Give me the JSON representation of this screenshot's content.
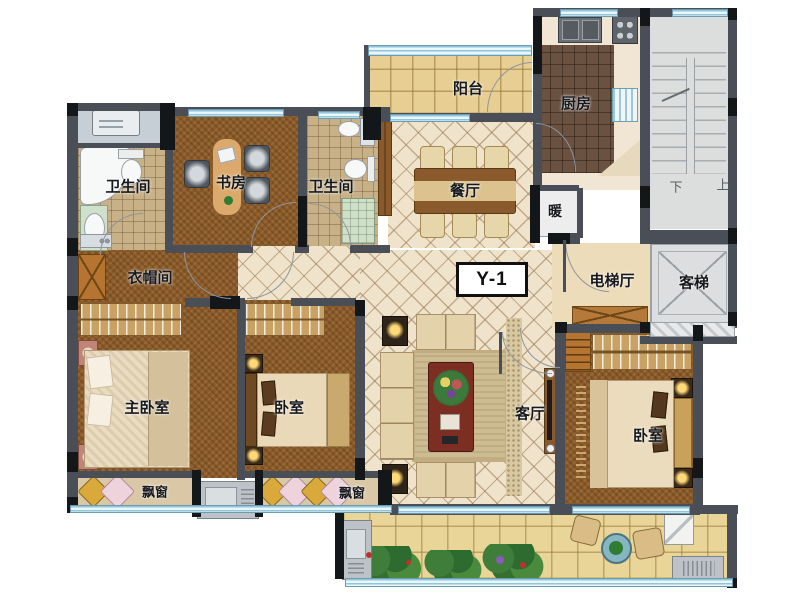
{
  "floorplan": {
    "unit_label": "Y-1",
    "labels": {
      "balcony_top": "阳台",
      "kitchen": "厨房",
      "stairs_down": "下",
      "stairs_up": "上",
      "bath_left": "卫生间",
      "bath_mid": "卫生间",
      "study": "书房",
      "dining": "餐厅",
      "heater": "暖",
      "elevator_hall": "电梯厅",
      "guest_elevator": "客梯",
      "cloakroom": "衣帽间",
      "master_bedroom": "主卧室",
      "bedroom_mid": "卧室",
      "bedroom_right": "卧室",
      "living": "客厅",
      "bay_window_left": "飘窗",
      "bay_window_mid": "飘窗"
    },
    "colors": {
      "wall": "#4a4f57",
      "wall_dark": "#14171a",
      "window": "#cfe9f4",
      "wood_floor": "#8a5a29",
      "tile_cream": "#efe3cc",
      "tile_bath": "#c8b087",
      "tile_kitchen": "#6a5140",
      "tile_balcony": "#e7cf93",
      "stairwell": "#dcdddd",
      "coffee_table": "#7c2e22"
    }
  }
}
